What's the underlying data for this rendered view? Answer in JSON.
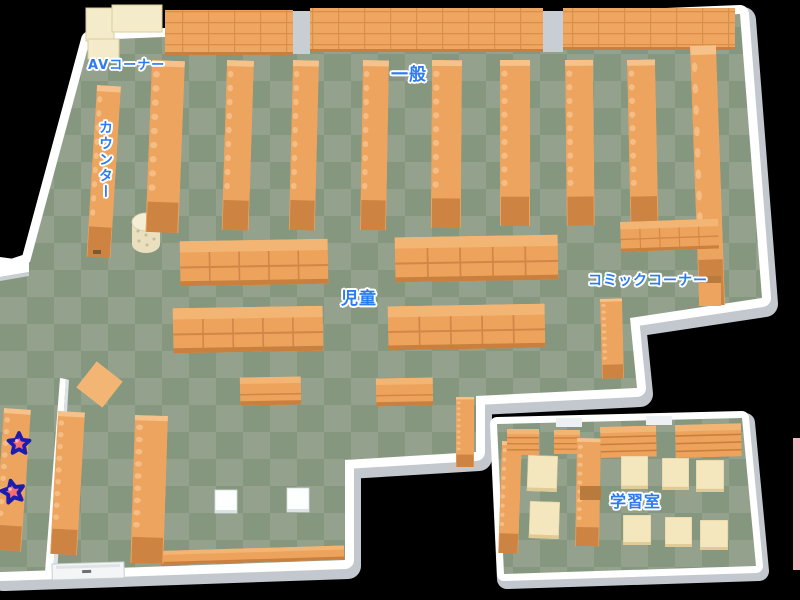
{
  "map": {
    "type": "library-floor-map",
    "areas": {
      "av_corner": "AVコーナー",
      "general": "一般",
      "counter": "カウンター",
      "children": "児童",
      "comic_corner": "コミックコーナー",
      "study_room": "学習室"
    },
    "markers": {
      "stars": {
        "count": 2,
        "fill": "#f47070",
        "outline": "#1c1cae"
      }
    },
    "palette": {
      "background": "#000000",
      "floor_light": "#93a18d",
      "floor_dark": "#86977f",
      "shelf_orange": "#eda35c",
      "shelf_orange_light": "#f3b573",
      "shelf_orange_dark": "#c9803f",
      "wall_white": "#ffffff",
      "wall_gray": "#c6cbd1",
      "av_cream": "#f3ebc9",
      "table_cream": "#f5e7bd",
      "label_blue": "#2b7bf2",
      "edge_pink": "#f3b6c2"
    }
  }
}
